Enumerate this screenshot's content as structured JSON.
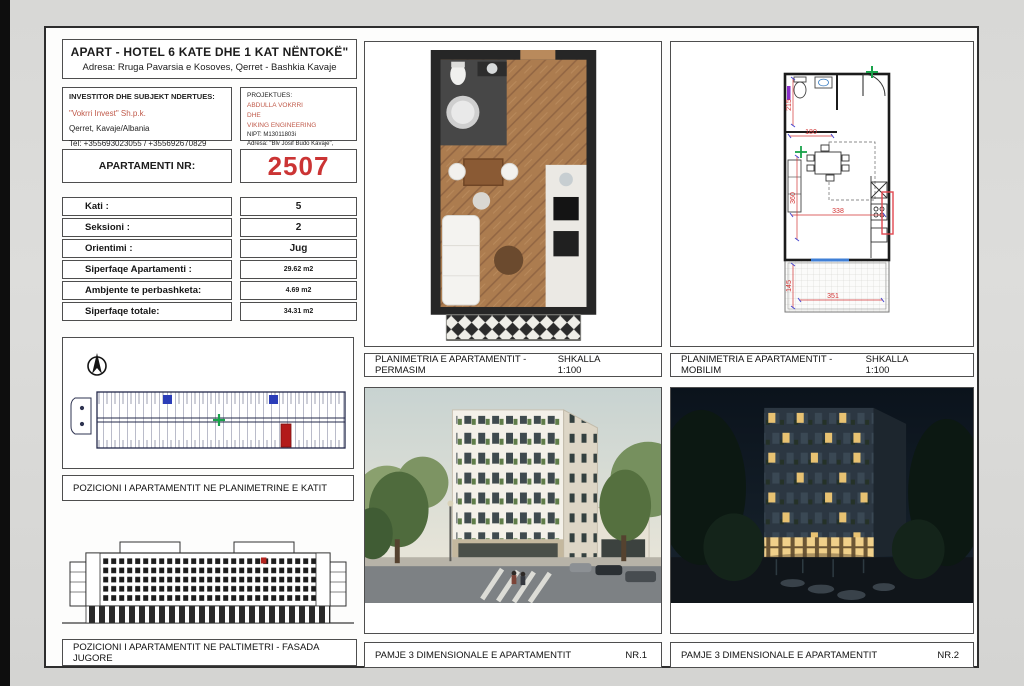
{
  "header": {
    "title": "APART - HOTEL 6 KATE DHE 1 KAT NËNTOKË\"",
    "address": "Adresa: Rruga Pavarsia e Kosoves, Qerret - Bashkia Kavaje"
  },
  "investor": {
    "heading": "INVESTITOR DHE SUBJEKT NDERTUES:",
    "name": "\"Vokrri Invest\" Sh.p.k.",
    "city": "Qerret, Kavaje/Albania",
    "phone": "Tel: +355693023055 / +355692670829"
  },
  "designer": {
    "heading": "PROJEKTUES:",
    "name": "ABDULLA VOKRRI",
    "conjunction": "DHE",
    "company": "VIKING ENGINEERING",
    "nipt": "NIPT: M13011803i",
    "address": "Adresa: \"Blv Josif Budo Kavaje\","
  },
  "apartment": {
    "label": "APARTAMENTI NR:",
    "number": "2507"
  },
  "details": {
    "rows": [
      {
        "label": "Kati :",
        "value": "5"
      },
      {
        "label": "Seksioni :",
        "value": "2"
      },
      {
        "label": "Orientimi :",
        "value": "Jug"
      },
      {
        "label": "Siperfaqe Apartamenti :",
        "value": "29.62 m2"
      },
      {
        "label": "Ambjente te perbashketa:",
        "value": "4.69 m2"
      },
      {
        "label": "Siperfaqe totale:",
        "value": "34.31 m2"
      }
    ]
  },
  "panels": {
    "position_plan_label": "POZICIONI I APARTAMENTIT NE PLANIMETRINE E KATIT",
    "facade_label": "POZICIONI I APARTAMENTIT NE PALTIMETRI - FASADA JUGORE",
    "plan_permasim_label": "PLANIMETRIA E APARTAMENTIT - PERMASIM",
    "plan_permasim_scale": "SHKALLA 1:100",
    "plan_mobilim_label": "PLANIMETRIA E APARTAMENTIT - MOBILIM",
    "plan_mobilim_scale": "SHKALLA 1:100",
    "view1_label": "PAMJE 3 DIMENSIONALE E APARTAMENTIT",
    "view1_number": "NR.1",
    "view2_label": "PAMJE 3 DIMENSIONALE E APARTAMENTIT",
    "view2_number": "NR.2"
  },
  "tech_plan": {
    "dim_bath_height": "215",
    "dim_bath_width": "180",
    "dim_living_height": "360",
    "dim_living_width": "338",
    "dim_balcony_height": "145",
    "dim_balcony_width": "351"
  },
  "colors": {
    "apartment_number_red": "#cb3434",
    "investor_red": "#c05a4a",
    "dimension_red": "#d23333",
    "highlight_red": "#b31a1a",
    "marker_green": "#19a24a",
    "marker_blue": "#2b3db8"
  }
}
